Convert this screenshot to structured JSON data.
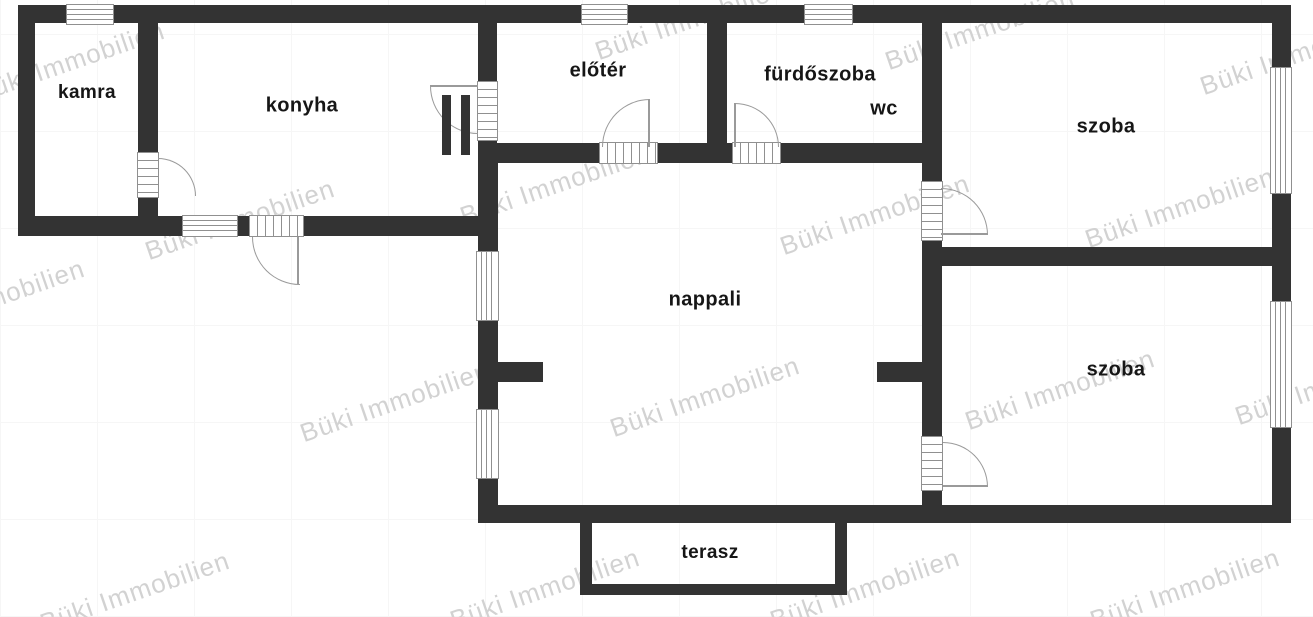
{
  "watermark": {
    "text": "Büki Immobilien"
  },
  "rooms": {
    "kamra": "kamra",
    "konyha": "konyha",
    "eloter": "előtér",
    "furdoszoba": "fürdőszoba",
    "wc": "wc",
    "szoba1": "szoba",
    "nappali": "nappali",
    "szoba2": "szoba",
    "terasz": "terasz"
  },
  "colors": {
    "wall": "#333333",
    "label": "#161616",
    "watermark": "#d2d2d2",
    "window_line": "#909090"
  }
}
